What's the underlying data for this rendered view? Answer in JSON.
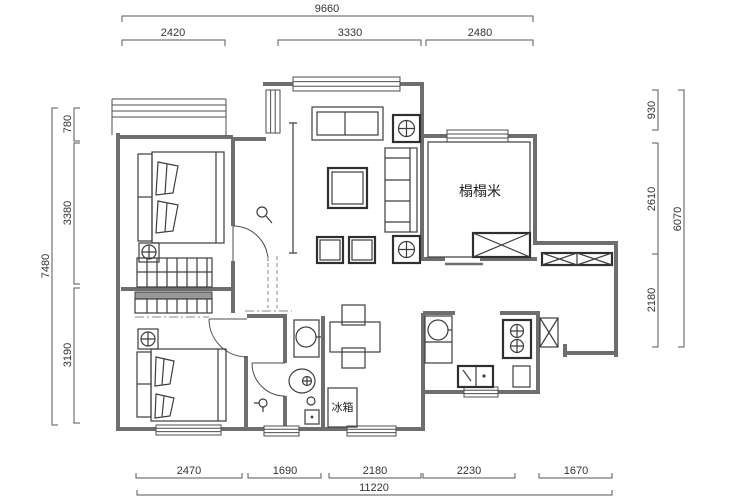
{
  "drawing": {
    "type": "apartment-floor-plan",
    "labels": {
      "tatami_room": "榻榻米",
      "fridge": "冰箱"
    },
    "dimensions": {
      "top": {
        "total": "9660",
        "segments": [
          "2420",
          "3330",
          "2480"
        ]
      },
      "bottom": {
        "total": "11220",
        "segments": [
          "2470",
          "1690",
          "2180",
          "2230",
          "1670"
        ]
      },
      "left": {
        "total": "7480",
        "segments": [
          "780",
          "3380",
          "3190"
        ]
      },
      "right": {
        "total": "6070",
        "segments": [
          "930",
          "2610",
          "2180"
        ]
      }
    },
    "colors": {
      "background": "#ffffff",
      "walls": "#6e6e6e",
      "furniture": "#3d3d3d",
      "dimension_lines": "#555555",
      "text": "#333333"
    }
  }
}
